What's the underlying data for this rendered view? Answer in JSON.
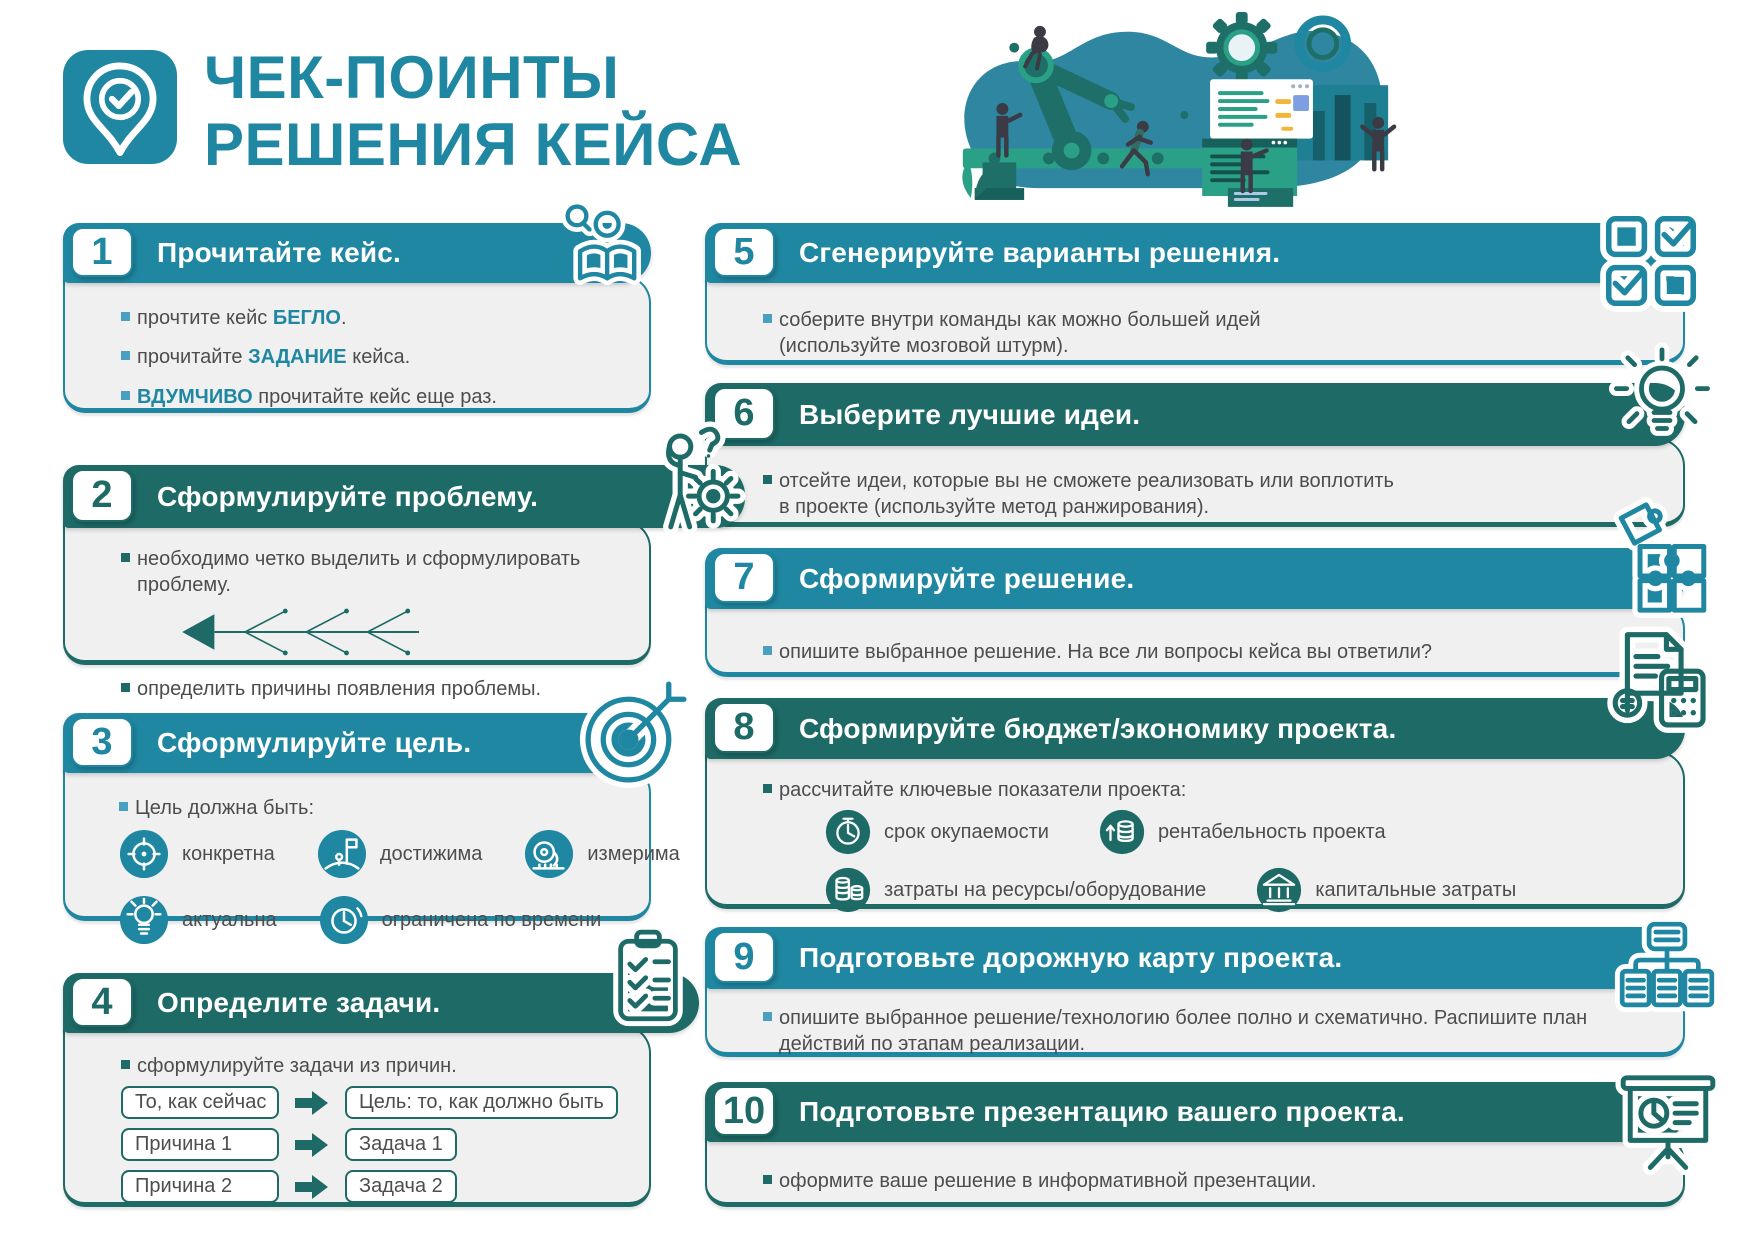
{
  "page": {
    "background": "#ffffff"
  },
  "colors": {
    "accent_light": "#1f87a1",
    "accent_dark": "#1d6a66",
    "card_body_bg": "#f0f0f1",
    "text": "#4d4d4d",
    "highlight": "#1f87a1"
  },
  "header": {
    "logo_icon": "location-pin-check-icon",
    "title_line1": "ЧЕК-ПОИНТЫ",
    "title_line2": "РЕШЕНИЯ КЕЙСА",
    "illustration": "people-building-process-illustration"
  },
  "cards": [
    {
      "number": "1",
      "theme": "light",
      "icon": "reading-person-icon",
      "title": "Прочитайте кейс.",
      "bullets": [
        {
          "pre": "прочтите кейс ",
          "hl": "БЕГЛО",
          "post": "."
        },
        {
          "pre": "прочитайте ",
          "hl": "ЗАДАНИЕ",
          "post": " кейса."
        },
        {
          "pre": "",
          "hl": "ВДУМЧИВО",
          "post": " прочитайте кейс еще раз."
        }
      ]
    },
    {
      "number": "2",
      "theme": "dark",
      "icon": "thinking-person-gear-icon",
      "title": "Сформулируйте проблему.",
      "diagram": "fishbone-arrow-diagram",
      "bullets": [
        {
          "text": "необходимо четко выделить и сформулировать\nпроблему."
        },
        {
          "text": "определить причины появления проблемы."
        }
      ]
    },
    {
      "number": "3",
      "theme": "light",
      "icon": "target-arrow-icon",
      "title": "Сформулируйте цель.",
      "intro": "Цель должна быть:",
      "items": [
        {
          "icon": "target-icon",
          "label": "конкретна"
        },
        {
          "icon": "flag-on-mountain-icon",
          "label": "достижима"
        },
        {
          "icon": "measuring-tape-icon",
          "label": "измерима"
        },
        {
          "icon": "lightbulb-icon",
          "label": "актуальна"
        },
        {
          "icon": "clock-icon",
          "label": "ограничена по времени"
        }
      ]
    },
    {
      "number": "4",
      "theme": "dark",
      "icon": "clipboard-checklist-icon",
      "title": "Определите задачи.",
      "bullets": [
        {
          "text": "сформулируйте задачи из причин."
        }
      ],
      "flow": [
        {
          "from": "То, как сейчас",
          "to": "Цель: то, как должно быть"
        },
        {
          "from": "Причина 1",
          "to": "Задача 1"
        },
        {
          "from": "Причина 2",
          "to": "Задача 2"
        }
      ]
    },
    {
      "number": "5",
      "theme": "light",
      "icon": "checkboxes-icon",
      "title": "Сгенерируйте варианты решения.",
      "bullets": [
        {
          "text": "соберите внутри команды как можно большей идей\n(используйте мозговой штурм)."
        }
      ]
    },
    {
      "number": "6",
      "theme": "dark",
      "icon": "lightbulb-rays-icon",
      "title": "Выберите лучшие идеи.",
      "bullets": [
        {
          "text": "отсейте идеи, которые вы не сможете реализовать или воплотить\nв проекте (используйте метод ранжирования)."
        }
      ]
    },
    {
      "number": "7",
      "theme": "light",
      "icon": "puzzle-pieces-icon",
      "title": "Сформируйте решение.",
      "bullets": [
        {
          "text": "опишите выбранное решение. На все ли вопросы кейса вы ответили?"
        }
      ]
    },
    {
      "number": "8",
      "theme": "dark",
      "icon": "document-calculator-icon",
      "title": "Сформируйте бюджет/экономику проекта.",
      "bullets": [
        {
          "text": "рассчитайте ключевые показатели проекта:"
        }
      ],
      "items": [
        {
          "icon": "stopwatch-icon",
          "label": "срок окупаемости"
        },
        {
          "icon": "coins-growth-icon",
          "label": "рентабельность проекта"
        },
        {
          "icon": "coins-stack-icon",
          "label": "затраты на ресурсы/оборудование"
        },
        {
          "icon": "bank-icon",
          "label": "капитальные затраты"
        }
      ]
    },
    {
      "number": "9",
      "theme": "light",
      "icon": "sitemap-icon",
      "title": "Подготовьте дорожную карту проекта.",
      "bullets": [
        {
          "text": "опишите выбранное решение/технологию более полно и схематично. Распишите план\nдействий по этапам реализации."
        }
      ]
    },
    {
      "number": "10",
      "theme": "dark",
      "icon": "presentation-board-icon",
      "title": "Подготовьте презентацию вашего проекта.",
      "bullets": [
        {
          "text": "оформите ваше решение в информативной презентации."
        }
      ]
    }
  ]
}
